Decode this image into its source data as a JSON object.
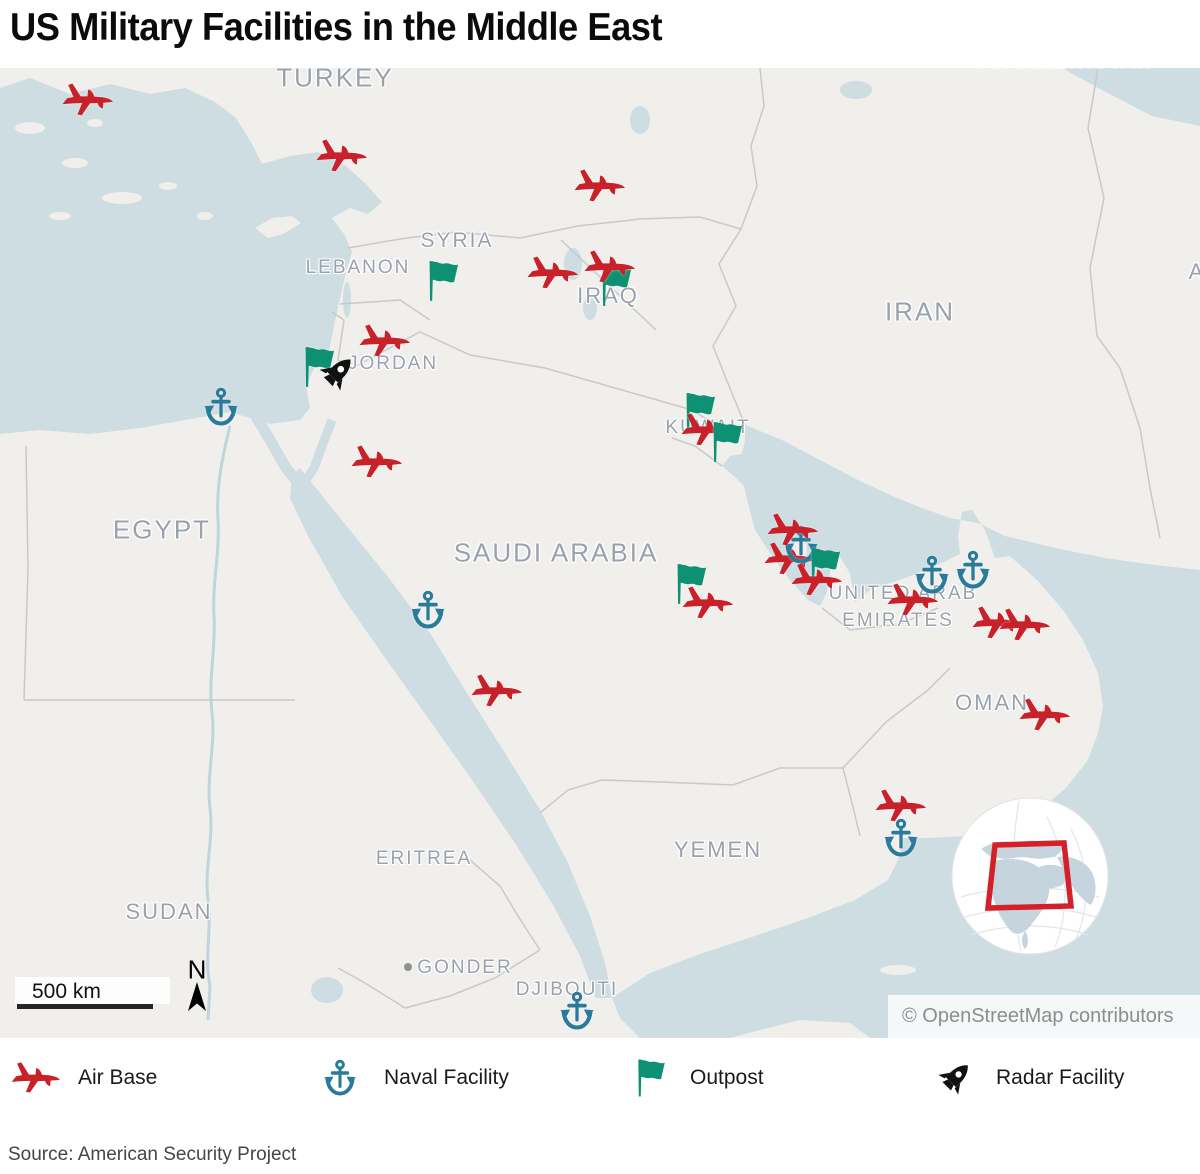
{
  "title": "US Military Facilities in the Middle East",
  "colors": {
    "air_base": "#c82129",
    "naval_facility": "#2a7b9b",
    "outpost": "#0e9173",
    "radar_facility": "#111111",
    "water": "#cddde2",
    "land": "#f0efec",
    "country_label": "#99a1ad",
    "inset_box": "#d42028"
  },
  "map": {
    "attribution": "© OpenStreetMap contributors",
    "scale_label": "500 km",
    "north_label": "N",
    "country_labels": [
      {
        "text": "TURKEY",
        "x": 335,
        "y": 10,
        "size": 26
      },
      {
        "text": "TURKMENISTAN",
        "x": 1063,
        "y": -6,
        "size": 20
      },
      {
        "text": "SYRIA",
        "x": 457,
        "y": 173,
        "size": 21
      },
      {
        "text": "LEBANON",
        "x": 358,
        "y": 200,
        "size": 19
      },
      {
        "text": "IRAQ",
        "x": 608,
        "y": 228,
        "size": 22
      },
      {
        "text": "IRAN",
        "x": 920,
        "y": 244,
        "size": 26
      },
      {
        "text": "JORDAN",
        "x": 393,
        "y": 296,
        "size": 19
      },
      {
        "text": "KUWAIT",
        "x": 708,
        "y": 360,
        "size": 19
      },
      {
        "text": "EGYPT",
        "x": 162,
        "y": 462,
        "size": 26
      },
      {
        "text": "SAUDI ARABIA",
        "x": 556,
        "y": 485,
        "size": 26
      },
      {
        "text": "UNITED ARAB",
        "x": 903,
        "y": 526,
        "size": 19
      },
      {
        "text": "EMIRATES",
        "x": 898,
        "y": 553,
        "size": 19
      },
      {
        "text": "OMAN",
        "x": 992,
        "y": 635,
        "size": 22
      },
      {
        "text": "YEMEN",
        "x": 718,
        "y": 782,
        "size": 22
      },
      {
        "text": "ERITREA",
        "x": 424,
        "y": 791,
        "size": 19
      },
      {
        "text": "SUDAN",
        "x": 169,
        "y": 844,
        "size": 22
      },
      {
        "text": "GONDER",
        "x": 465,
        "y": 900,
        "size": 19
      },
      {
        "text": "DJIBOUTI",
        "x": 567,
        "y": 922,
        "size": 19
      },
      {
        "text": "A",
        "x": 1197,
        "y": 204,
        "size": 22
      }
    ],
    "city_marker": {
      "name": "GONDER",
      "x": 408,
      "y": 899
    },
    "facilities": [
      {
        "type": "air-base",
        "x": 88,
        "y": 32
      },
      {
        "type": "air-base",
        "x": 342,
        "y": 88
      },
      {
        "type": "air-base",
        "x": 600,
        "y": 118
      },
      {
        "type": "air-base",
        "x": 553,
        "y": 205
      },
      {
        "type": "outpost",
        "x": 440,
        "y": 213
      },
      {
        "type": "outpost",
        "x": 613,
        "y": 218
      },
      {
        "type": "air-base",
        "x": 610,
        "y": 199
      },
      {
        "type": "air-base",
        "x": 385,
        "y": 273
      },
      {
        "type": "outpost",
        "x": 316,
        "y": 299
      },
      {
        "type": "radar-facility",
        "x": 337,
        "y": 305
      },
      {
        "type": "naval-facility",
        "x": 221,
        "y": 339
      },
      {
        "type": "air-base",
        "x": 377,
        "y": 394
      },
      {
        "type": "outpost",
        "x": 697,
        "y": 345
      },
      {
        "type": "air-base",
        "x": 707,
        "y": 362
      },
      {
        "type": "outpost",
        "x": 724,
        "y": 374
      },
      {
        "type": "naval-facility",
        "x": 428,
        "y": 542
      },
      {
        "type": "air-base",
        "x": 790,
        "y": 491
      },
      {
        "type": "naval-facility",
        "x": 801,
        "y": 477
      },
      {
        "type": "air-base",
        "x": 793,
        "y": 462
      },
      {
        "type": "outpost",
        "x": 822,
        "y": 500
      },
      {
        "type": "air-base",
        "x": 817,
        "y": 512
      },
      {
        "type": "outpost",
        "x": 688,
        "y": 516
      },
      {
        "type": "air-base",
        "x": 708,
        "y": 535
      },
      {
        "type": "air-base",
        "x": 497,
        "y": 623
      },
      {
        "type": "naval-facility",
        "x": 932,
        "y": 507
      },
      {
        "type": "naval-facility",
        "x": 973,
        "y": 502
      },
      {
        "type": "air-base",
        "x": 913,
        "y": 532
      },
      {
        "type": "air-base",
        "x": 998,
        "y": 555
      },
      {
        "type": "air-base",
        "x": 1025,
        "y": 557
      },
      {
        "type": "air-base",
        "x": 1045,
        "y": 647
      },
      {
        "type": "air-base",
        "x": 901,
        "y": 738
      },
      {
        "type": "naval-facility",
        "x": 901,
        "y": 770
      },
      {
        "type": "naval-facility",
        "x": 577,
        "y": 943
      }
    ]
  },
  "legend": {
    "items": [
      {
        "type": "air-base",
        "label": "Air Base",
        "icon_x": 36,
        "label_x": 78
      },
      {
        "type": "naval-facility",
        "label": "Naval Facility",
        "icon_x": 340,
        "label_x": 384
      },
      {
        "type": "outpost",
        "label": "Outpost",
        "icon_x": 648,
        "label_x": 690
      },
      {
        "type": "radar-facility",
        "label": "Radar Facility",
        "icon_x": 955,
        "label_x": 996
      }
    ]
  },
  "source": "Source: American Security Project"
}
